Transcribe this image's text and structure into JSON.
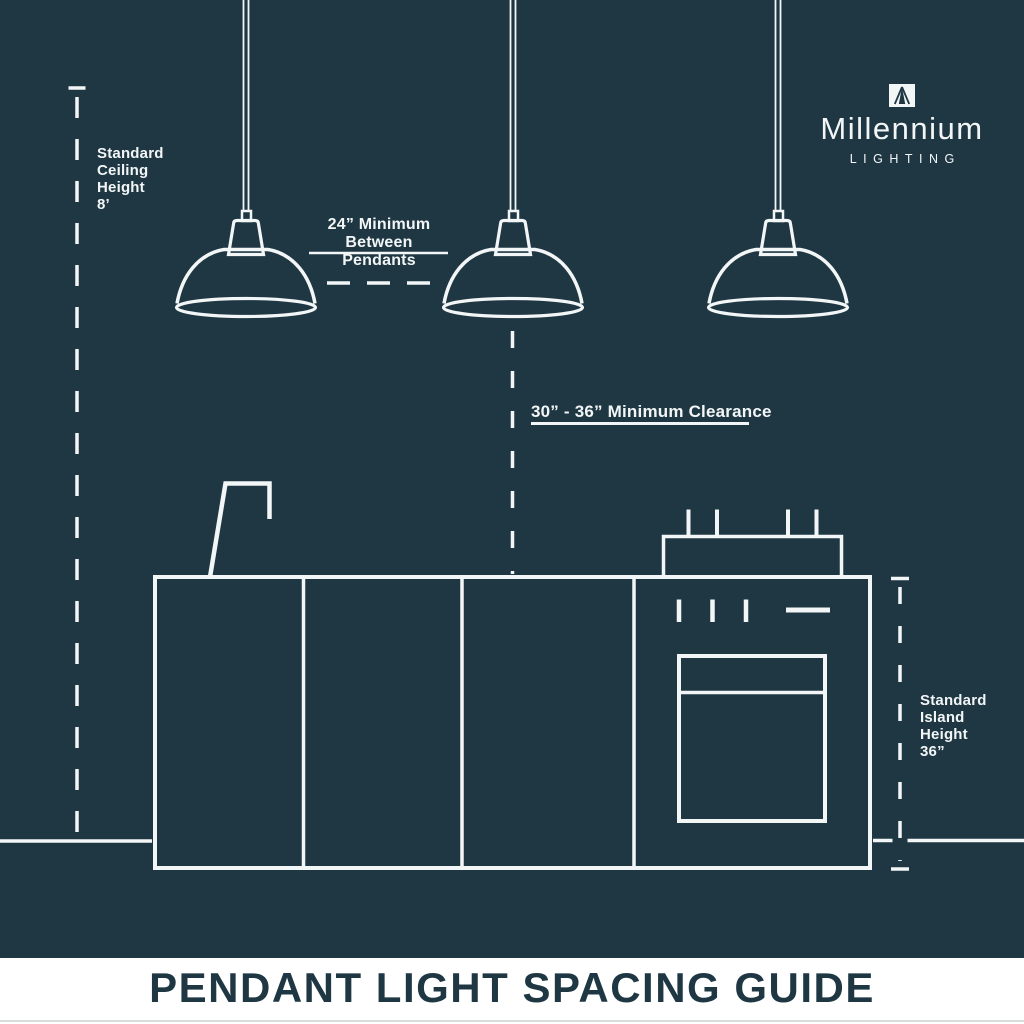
{
  "colors": {
    "background": "#1e3743",
    "line": "#f3f6f7",
    "banner_bg": "#ffffff",
    "banner_text": "#1e3743",
    "banner_edge": "#d9dcdd"
  },
  "logo": {
    "icon": "pendant-beam-icon",
    "brand": "Millennium",
    "tagline": "LIGHTING"
  },
  "annotations": {
    "ceiling_height": "Standard\nCeiling\nHeight\n8’",
    "between_pendants": "24” Minimum\nBetween Pendants",
    "clearance": "30” - 36” Minimum Clearance",
    "island_height": "Standard\nIsland\nHeight\n36”"
  },
  "banner": {
    "title": "PENDANT LIGHT SPACING GUIDE"
  },
  "diagram": {
    "pendant_count": 3,
    "objects": [
      "pendant-lights",
      "ceiling-height-dimension-line",
      "pendant-spacing-dashed-line",
      "clearance-dashed-line",
      "kitchen-island",
      "faucet",
      "range-and-oven",
      "island-height-dimension-line",
      "floor-line"
    ]
  }
}
